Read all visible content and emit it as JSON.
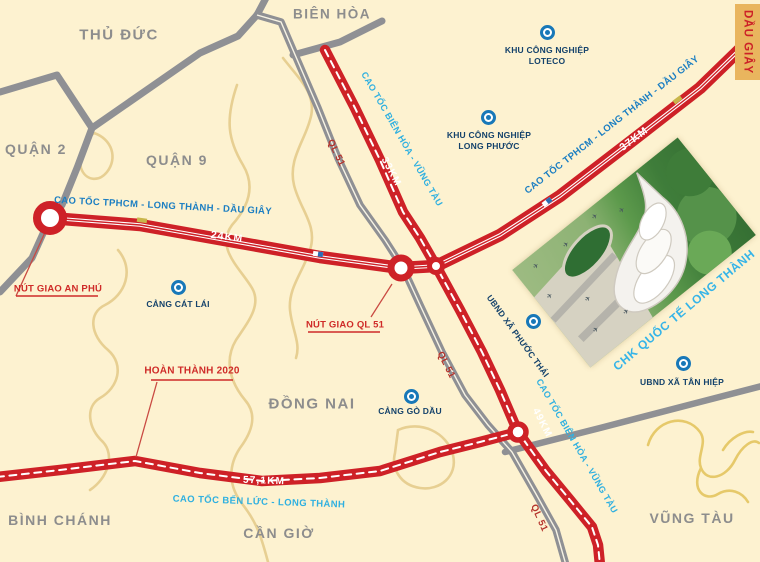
{
  "areas": {
    "thu_duc": "THỦ ĐỨC",
    "bien_hoa": "BIÊN HÒA",
    "quan_2": "QUẬN 2",
    "quan_9": "QUẬN 9",
    "dong_nai": "ĐỒNG NAI",
    "binh_chanh": "BÌNH CHÁNH",
    "can_gio": "CẦN GIỜ",
    "vung_tau": "VŨNG TÀU"
  },
  "highways": {
    "hlmd_name": "CAO TỐC TPHCM - LONG THÀNH - DẦU GIÂY",
    "hlmd_name_diag": "CAO TỐC TPHCM - LONG THÀNH - DẦU GIÂY",
    "hlmd_km_west": "24KM",
    "hlmd_km_east": "37KM",
    "bhvt_name_north": "CAO TỐC BIÊN HÒA - VŨNG TÀU",
    "bhvt_name_south": "CAO TỐC BIÊN HÒA - VŨNG TÀU",
    "bhvt_km_north": "33KM",
    "bhvt_km_south": "49KM",
    "blt_name": "CAO TỐC BẾN LỨC - LONG THÀNH",
    "blt_km": "57,1KM",
    "ql51_north": "QL 51",
    "ql51_mid": "QL 51",
    "ql51_south": "QL 51"
  },
  "junctions": {
    "an_phu": "NÚT GIAO AN PHÚ",
    "ql51": "NÚT GIAO QL 51"
  },
  "note": {
    "hoan_thanh": "HOÀN THÀNH 2020"
  },
  "places": {
    "loteco": "KHU CÔNG NGHIỆP LOTECO",
    "long_phuoc": "KHU CÔNG NGHIỆP LONG PHƯỚC",
    "cat_lai": "CẢNG CÁT LÁI",
    "go_dau": "CẢNG GÒ DẦU",
    "phuoc_thai": "UBND XÃ PHƯỚC THÁI",
    "tan_hiep": "UBND XÃ TÂN HIỆP"
  },
  "airport": {
    "label": "CHK QUỐC TẾ LONG THÀNH"
  },
  "badge": {
    "dau_giay": "DẦU GIÂY"
  },
  "colors": {
    "background": "#fdf2d0",
    "expressway_red": "#ce2127",
    "road_gray": "#8f9094",
    "boundary_tan": "#e7cf92",
    "label_blue": "#1b7ec2",
    "label_cyan": "#2fb0e0",
    "label_navy": "#14426b",
    "label_red": "#cf2b28",
    "area_gray": "#8d8d8d",
    "badge_bg": "#e9b55e",
    "marker_blue": "#1878b8"
  }
}
